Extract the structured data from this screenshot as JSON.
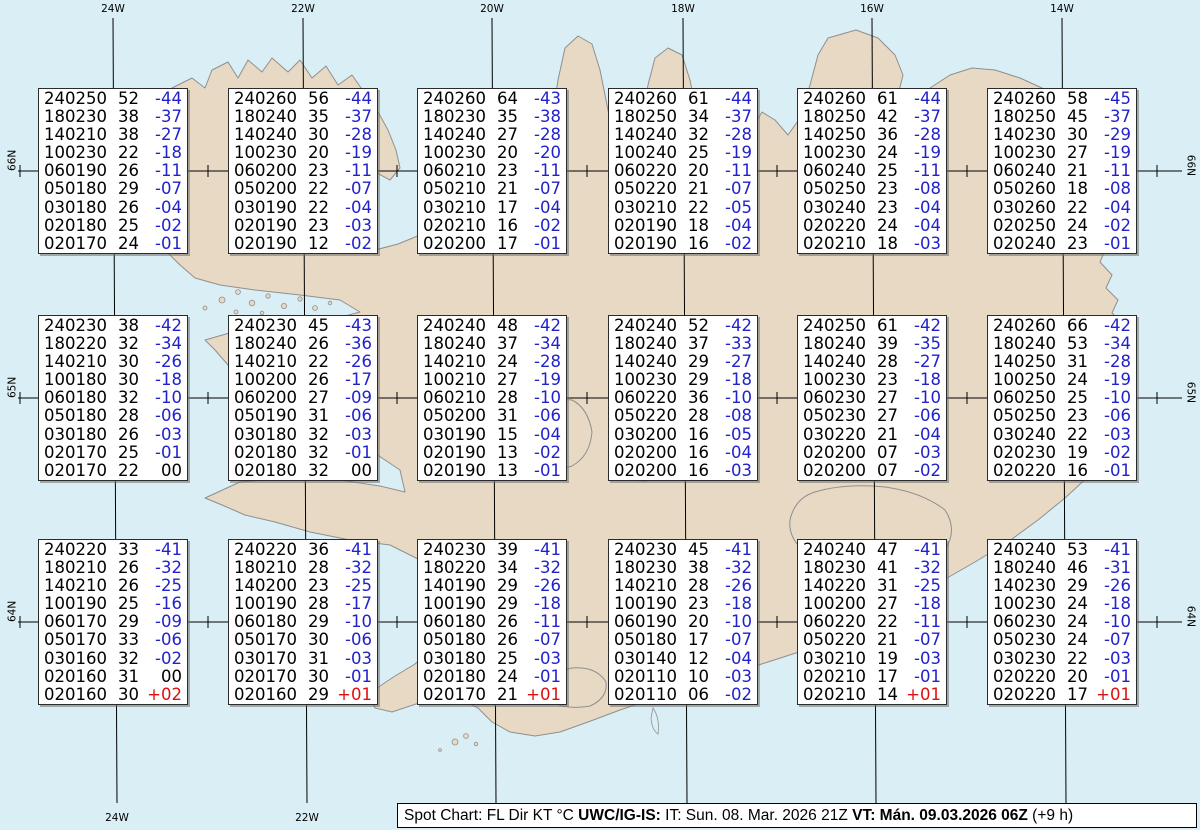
{
  "map": {
    "sea_color": "#daeff5",
    "land_color": "#e7d9c4",
    "coast_color": "#8f8f8f",
    "grid_color": "#000000",
    "top_longitudes": [
      {
        "label": "24W",
        "x": 113
      },
      {
        "label": "22W",
        "x": 303
      },
      {
        "label": "20W",
        "x": 492
      },
      {
        "label": "18W",
        "x": 683
      },
      {
        "label": "16W",
        "x": 872
      },
      {
        "label": "14W",
        "x": 1062
      }
    ],
    "bottom_longitudes": [
      {
        "label": "24W",
        "x": 117
      },
      {
        "label": "22W",
        "x": 307
      }
    ],
    "left_latitudes": [
      {
        "label": "66N",
        "y": 171
      },
      {
        "label": "65N",
        "y": 398
      },
      {
        "label": "64N",
        "y": 622
      }
    ],
    "right_latitudes": [
      {
        "label": "66N",
        "y": 176
      },
      {
        "label": "65N",
        "y": 403
      },
      {
        "label": "64N",
        "y": 627
      }
    ],
    "cross_x": [
      20,
      208,
      397,
      587,
      777,
      967,
      1157
    ],
    "grid_top_y": 18,
    "grid_bottom_y": 803,
    "meridian_bottom_shift": 4
  },
  "spots": {
    "columns_x": [
      113,
      303,
      492,
      683,
      872,
      1062
    ],
    "rows_y": [
      171,
      398,
      622
    ],
    "colors": {
      "code": "#000000",
      "negative": "#2222cc",
      "positive": "#dd1111",
      "zero": "#000000"
    },
    "boxes": [
      {
        "row": 0,
        "col": 0,
        "lines": [
          [
            "240250",
            "52",
            "-44"
          ],
          [
            "180230",
            "38",
            "-37"
          ],
          [
            "140210",
            "38",
            "-27"
          ],
          [
            "100230",
            "22",
            "-18"
          ],
          [
            "060190",
            "26",
            "-11"
          ],
          [
            "050180",
            "29",
            "-07"
          ],
          [
            "030180",
            "26",
            "-04"
          ],
          [
            "020180",
            "25",
            "-02"
          ],
          [
            "020170",
            "24",
            "-01"
          ]
        ]
      },
      {
        "row": 0,
        "col": 1,
        "lines": [
          [
            "240260",
            "56",
            "-44"
          ],
          [
            "180240",
            "35",
            "-37"
          ],
          [
            "140240",
            "30",
            "-28"
          ],
          [
            "100230",
            "20",
            "-19"
          ],
          [
            "060200",
            "23",
            "-11"
          ],
          [
            "050200",
            "22",
            "-07"
          ],
          [
            "030190",
            "22",
            "-04"
          ],
          [
            "020190",
            "23",
            "-03"
          ],
          [
            "020190",
            "12",
            "-02"
          ]
        ]
      },
      {
        "row": 0,
        "col": 2,
        "lines": [
          [
            "240260",
            "64",
            "-43"
          ],
          [
            "180230",
            "35",
            "-38"
          ],
          [
            "140240",
            "27",
            "-28"
          ],
          [
            "100230",
            "20",
            "-20"
          ],
          [
            "060210",
            "23",
            "-11"
          ],
          [
            "050210",
            "21",
            "-07"
          ],
          [
            "030210",
            "17",
            "-04"
          ],
          [
            "020210",
            "16",
            "-02"
          ],
          [
            "020200",
            "17",
            "-01"
          ]
        ]
      },
      {
        "row": 0,
        "col": 3,
        "lines": [
          [
            "240260",
            "61",
            "-44"
          ],
          [
            "180250",
            "34",
            "-37"
          ],
          [
            "140240",
            "32",
            "-28"
          ],
          [
            "100240",
            "25",
            "-19"
          ],
          [
            "060220",
            "20",
            "-11"
          ],
          [
            "050220",
            "21",
            "-07"
          ],
          [
            "030210",
            "22",
            "-05"
          ],
          [
            "020190",
            "18",
            "-04"
          ],
          [
            "020190",
            "16",
            "-02"
          ]
        ]
      },
      {
        "row": 0,
        "col": 4,
        "lines": [
          [
            "240260",
            "61",
            "-44"
          ],
          [
            "180250",
            "42",
            "-37"
          ],
          [
            "140250",
            "36",
            "-28"
          ],
          [
            "100230",
            "24",
            "-19"
          ],
          [
            "060240",
            "25",
            "-11"
          ],
          [
            "050250",
            "23",
            "-08"
          ],
          [
            "030240",
            "23",
            "-04"
          ],
          [
            "020220",
            "24",
            "-04"
          ],
          [
            "020210",
            "18",
            "-03"
          ]
        ]
      },
      {
        "row": 0,
        "col": 5,
        "lines": [
          [
            "240260",
            "58",
            "-45"
          ],
          [
            "180250",
            "45",
            "-37"
          ],
          [
            "140230",
            "30",
            "-29"
          ],
          [
            "100230",
            "27",
            "-19"
          ],
          [
            "060240",
            "21",
            "-11"
          ],
          [
            "050260",
            "18",
            "-08"
          ],
          [
            "030260",
            "22",
            "-04"
          ],
          [
            "020250",
            "24",
            "-02"
          ],
          [
            "020240",
            "23",
            "-01"
          ]
        ]
      },
      {
        "row": 1,
        "col": 0,
        "lines": [
          [
            "240230",
            "38",
            "-42"
          ],
          [
            "180220",
            "32",
            "-34"
          ],
          [
            "140210",
            "30",
            "-26"
          ],
          [
            "100180",
            "30",
            "-18"
          ],
          [
            "060180",
            "32",
            "-10"
          ],
          [
            "050180",
            "28",
            "-06"
          ],
          [
            "030180",
            "26",
            "-03"
          ],
          [
            "020170",
            "25",
            "-01"
          ],
          [
            "020170",
            "22",
            "00"
          ]
        ]
      },
      {
        "row": 1,
        "col": 1,
        "lines": [
          [
            "240230",
            "45",
            "-43"
          ],
          [
            "180240",
            "26",
            "-36"
          ],
          [
            "140210",
            "22",
            "-26"
          ],
          [
            "100200",
            "26",
            "-17"
          ],
          [
            "060200",
            "27",
            "-09"
          ],
          [
            "050190",
            "31",
            "-06"
          ],
          [
            "030180",
            "32",
            "-03"
          ],
          [
            "020180",
            "32",
            "-01"
          ],
          [
            "020180",
            "32",
            "00"
          ]
        ]
      },
      {
        "row": 1,
        "col": 2,
        "lines": [
          [
            "240240",
            "48",
            "-42"
          ],
          [
            "180240",
            "37",
            "-34"
          ],
          [
            "140210",
            "24",
            "-28"
          ],
          [
            "100210",
            "27",
            "-19"
          ],
          [
            "060210",
            "28",
            "-10"
          ],
          [
            "050200",
            "31",
            "-06"
          ],
          [
            "030190",
            "15",
            "-04"
          ],
          [
            "020190",
            "13",
            "-02"
          ],
          [
            "020190",
            "13",
            "-01"
          ]
        ]
      },
      {
        "row": 1,
        "col": 3,
        "lines": [
          [
            "240240",
            "52",
            "-42"
          ],
          [
            "180240",
            "37",
            "-33"
          ],
          [
            "140240",
            "29",
            "-27"
          ],
          [
            "100230",
            "29",
            "-18"
          ],
          [
            "060220",
            "36",
            "-10"
          ],
          [
            "050220",
            "28",
            "-08"
          ],
          [
            "030200",
            "16",
            "-05"
          ],
          [
            "020200",
            "16",
            "-04"
          ],
          [
            "020200",
            "16",
            "-03"
          ]
        ]
      },
      {
        "row": 1,
        "col": 4,
        "lines": [
          [
            "240250",
            "61",
            "-42"
          ],
          [
            "180240",
            "39",
            "-35"
          ],
          [
            "140240",
            "28",
            "-27"
          ],
          [
            "100230",
            "23",
            "-18"
          ],
          [
            "060230",
            "27",
            "-10"
          ],
          [
            "050230",
            "27",
            "-06"
          ],
          [
            "030220",
            "21",
            "-04"
          ],
          [
            "020200",
            "07",
            "-03"
          ],
          [
            "020200",
            "07",
            "-02"
          ]
        ]
      },
      {
        "row": 1,
        "col": 5,
        "lines": [
          [
            "240260",
            "66",
            "-42"
          ],
          [
            "180240",
            "53",
            "-34"
          ],
          [
            "140250",
            "31",
            "-28"
          ],
          [
            "100250",
            "24",
            "-19"
          ],
          [
            "060250",
            "25",
            "-10"
          ],
          [
            "050250",
            "23",
            "-06"
          ],
          [
            "030240",
            "22",
            "-03"
          ],
          [
            "020230",
            "19",
            "-02"
          ],
          [
            "020220",
            "16",
            "-01"
          ]
        ]
      },
      {
        "row": 2,
        "col": 0,
        "lines": [
          [
            "240220",
            "33",
            "-41"
          ],
          [
            "180210",
            "26",
            "-32"
          ],
          [
            "140210",
            "26",
            "-25"
          ],
          [
            "100190",
            "25",
            "-16"
          ],
          [
            "060170",
            "29",
            "-09"
          ],
          [
            "050170",
            "33",
            "-06"
          ],
          [
            "030160",
            "32",
            "-02"
          ],
          [
            "020160",
            "31",
            "00"
          ],
          [
            "020160",
            "30",
            "+02"
          ]
        ]
      },
      {
        "row": 2,
        "col": 1,
        "lines": [
          [
            "240220",
            "36",
            "-41"
          ],
          [
            "180210",
            "28",
            "-32"
          ],
          [
            "140200",
            "23",
            "-25"
          ],
          [
            "100190",
            "28",
            "-17"
          ],
          [
            "060180",
            "29",
            "-10"
          ],
          [
            "050170",
            "30",
            "-06"
          ],
          [
            "030170",
            "31",
            "-03"
          ],
          [
            "020170",
            "30",
            "-01"
          ],
          [
            "020160",
            "29",
            "+01"
          ]
        ]
      },
      {
        "row": 2,
        "col": 2,
        "lines": [
          [
            "240230",
            "39",
            "-41"
          ],
          [
            "180220",
            "34",
            "-32"
          ],
          [
            "140190",
            "29",
            "-26"
          ],
          [
            "100190",
            "29",
            "-18"
          ],
          [
            "060180",
            "26",
            "-11"
          ],
          [
            "050180",
            "26",
            "-07"
          ],
          [
            "030180",
            "25",
            "-03"
          ],
          [
            "020180",
            "24",
            "-01"
          ],
          [
            "020170",
            "21",
            "+01"
          ]
        ]
      },
      {
        "row": 2,
        "col": 3,
        "lines": [
          [
            "240230",
            "45",
            "-41"
          ],
          [
            "180230",
            "38",
            "-32"
          ],
          [
            "140210",
            "28",
            "-26"
          ],
          [
            "100190",
            "23",
            "-18"
          ],
          [
            "060190",
            "20",
            "-10"
          ],
          [
            "050180",
            "17",
            "-07"
          ],
          [
            "030140",
            "12",
            "-04"
          ],
          [
            "020110",
            "10",
            "-03"
          ],
          [
            "020110",
            "06",
            "-02"
          ]
        ]
      },
      {
        "row": 2,
        "col": 4,
        "lines": [
          [
            "240240",
            "47",
            "-41"
          ],
          [
            "180230",
            "41",
            "-32"
          ],
          [
            "140220",
            "31",
            "-25"
          ],
          [
            "100200",
            "27",
            "-18"
          ],
          [
            "060220",
            "22",
            "-11"
          ],
          [
            "050220",
            "21",
            "-07"
          ],
          [
            "030210",
            "19",
            "-03"
          ],
          [
            "020210",
            "17",
            "-01"
          ],
          [
            "020210",
            "14",
            "+01"
          ]
        ]
      },
      {
        "row": 2,
        "col": 5,
        "lines": [
          [
            "240240",
            "53",
            "-41"
          ],
          [
            "180240",
            "46",
            "-31"
          ],
          [
            "140230",
            "29",
            "-26"
          ],
          [
            "100230",
            "24",
            "-18"
          ],
          [
            "060230",
            "24",
            "-10"
          ],
          [
            "050230",
            "24",
            "-07"
          ],
          [
            "030230",
            "22",
            "-03"
          ],
          [
            "020220",
            "20",
            "-01"
          ],
          [
            "020220",
            "17",
            "+01"
          ]
        ]
      }
    ]
  },
  "legend": {
    "segments": [
      {
        "text": "Spot Chart: FL Dir KT °C ",
        "bold": false
      },
      {
        "text": "UWC/IG-IS:",
        "bold": true
      },
      {
        "text": " IT: Sun. 08. Mar. 2026 21Z ",
        "bold": false
      },
      {
        "text": "VT: Mán. 09.03.2026 06Z",
        "bold": true
      },
      {
        "text": " (+9 h)",
        "bold": false
      }
    ]
  }
}
